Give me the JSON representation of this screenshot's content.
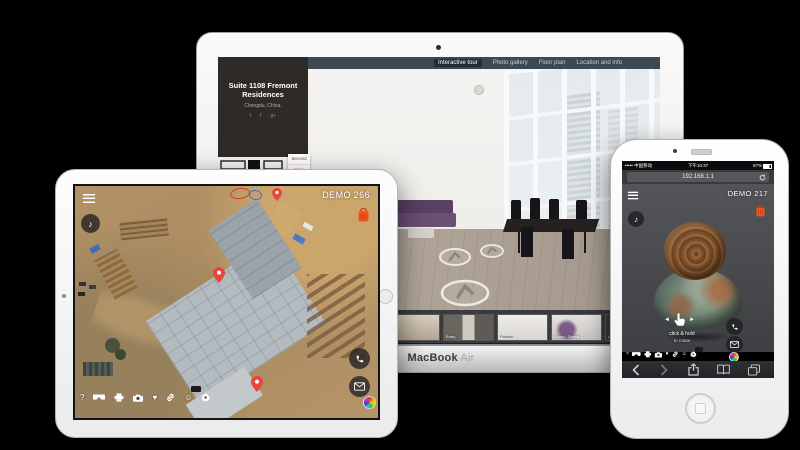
{
  "macbook": {
    "device_label": {
      "primary": "MacBook",
      "secondary": "Air"
    },
    "nav_tabs": [
      {
        "label": "Interactive tour",
        "active": true
      },
      {
        "label": "Photo gallery",
        "active": false
      },
      {
        "label": "Floor plan",
        "active": false
      },
      {
        "label": "Location and info",
        "active": false
      }
    ],
    "sidebar": {
      "title_line1": "Suite 1108 Fremont",
      "title_line2": "Residences",
      "subtitle": "Chengdu, China.",
      "social_icons": [
        "twitter",
        "facebook",
        "google-plus"
      ],
      "floor_selector": {
        "options": [
          "Second",
          "Main"
        ],
        "selected": "Main"
      }
    },
    "thumbnails": [
      {
        "label": ""
      },
      {
        "label": "Entry"
      },
      {
        "label": "Powder"
      },
      {
        "label": "Living / Dining"
      },
      {
        "label": "Living"
      }
    ]
  },
  "ipad": {
    "demo_label": "DEMO 266",
    "top_icons": [
      "menu",
      "music-note",
      "basket"
    ],
    "map_annotations": {
      "pins": 3,
      "sketch_ovals": [
        "red",
        "blue"
      ]
    },
    "side_buttons": [
      "phone",
      "email"
    ],
    "toolbar_icons": [
      "help",
      "vr-goggles",
      "printer",
      "camera",
      "heart",
      "link",
      "smiley",
      "settings"
    ]
  },
  "iphone": {
    "status_bar": {
      "carrier": "中国移动",
      "time": "下午10:37",
      "battery": "87%"
    },
    "url_bar": {
      "value": "192.168.1.1"
    },
    "demo_label": "DEMO 217",
    "hint": {
      "line1": "click & hold",
      "line2": "to rotate"
    },
    "top_icons": [
      "menu",
      "music-note",
      "basket"
    ],
    "side_buttons": [
      "phone",
      "email"
    ],
    "toolbar_icons": [
      "help",
      "vr-goggles",
      "printer",
      "camera",
      "heart",
      "link",
      "smiley",
      "settings"
    ],
    "safari_toolbar": [
      "back",
      "forward",
      "share",
      "bookmarks",
      "tabs"
    ]
  },
  "glyphs": {
    "help": "?",
    "music": "♪",
    "heart": "♥",
    "smiley": "☺",
    "arrow_left": "◄",
    "arrow_right": "►",
    "signal": "•••••",
    "twitter": "t",
    "facebook": "f",
    "gplus": "g+"
  },
  "colors": {
    "accent_orange": "#f2541b",
    "pin_red": "#e8453c",
    "tabbar": "#3c4954",
    "floor_selected": "#e2574c"
  }
}
